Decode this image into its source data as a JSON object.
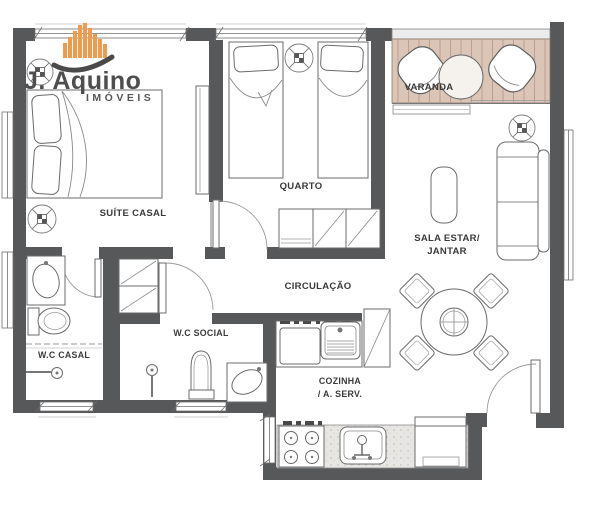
{
  "logo": {
    "name": "J. Aquino",
    "tagline": "IMÓVEIS",
    "skyline_color": "#EF9A4C",
    "swoosh_color": "#4A4A4A",
    "text_color": "#4E4E4E"
  },
  "rooms": {
    "suite": {
      "label": "SUÍTE CASAL"
    },
    "quarto": {
      "label": "QUARTO"
    },
    "varanda": {
      "label": "VARANDA"
    },
    "sala": {
      "line1": "SALA ESTAR/",
      "line2": "JANTAR"
    },
    "circulacao": {
      "label": "CIRCULAÇÃO"
    },
    "wc_casal": {
      "label": "W.C CASAL"
    },
    "wc_social": {
      "label": "W.C SOCIAL"
    },
    "cozinha": {
      "line1": "COZINHA",
      "line2": "/ A. SERV."
    }
  },
  "colors": {
    "wall": "#57585A",
    "deck": "#DBC5B6",
    "deck_line": "#B79C8D",
    "counter_speckle": "#E7E6E3",
    "furniture_line": "#6B6B6B",
    "label": "#3A3A3A",
    "background": "#FFFFFF"
  }
}
